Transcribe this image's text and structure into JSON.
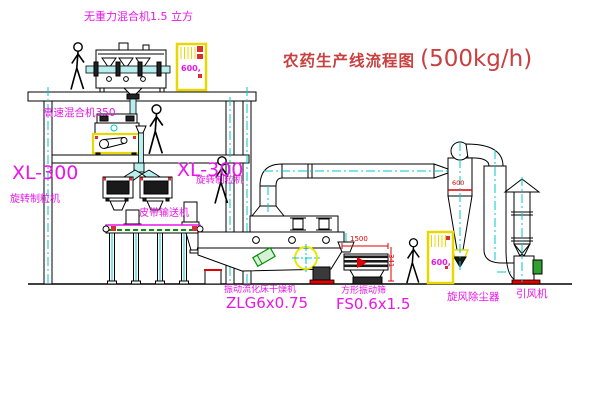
{
  "diagram": {
    "title": {
      "name_cn": "农药生产线流程图",
      "capacity": "(500kg/h)"
    },
    "labels": {
      "gravity_free_mixer": "无重力混合机1.5 立方",
      "high_speed_mixer": "高速混合机350",
      "granulator_left_model": "XL-300",
      "granulator_left_name": "旋转制粒机",
      "granulator_mid_model": "XL-300",
      "granulator_mid_name": "旋转制粒机",
      "belt_conveyor": "皮带输送机",
      "dryer_name": "振动流化床干燥机",
      "dryer_model": "ZLG6x0.75",
      "sieve_name": "方形振动筛",
      "sieve_model": "FS0.6x1.5",
      "cyclone": "旋风除尘器",
      "fan": "引风机"
    },
    "dimensions": {
      "sieve_length": "1500",
      "sieve_height": "341",
      "cyclone_size": "600"
    },
    "cabinets": {
      "top_cabinet_text": "600,",
      "right_cabinet_text": "600,"
    },
    "colors": {
      "line_black": "#000000",
      "centerline_cyan": "#00c8c8",
      "label_magenta": "#e816e8",
      "title_red": "#c84040",
      "dimension_red": "#e00000",
      "cabinet_yellow": "#e8d800",
      "belt_green": "#009000"
    }
  }
}
